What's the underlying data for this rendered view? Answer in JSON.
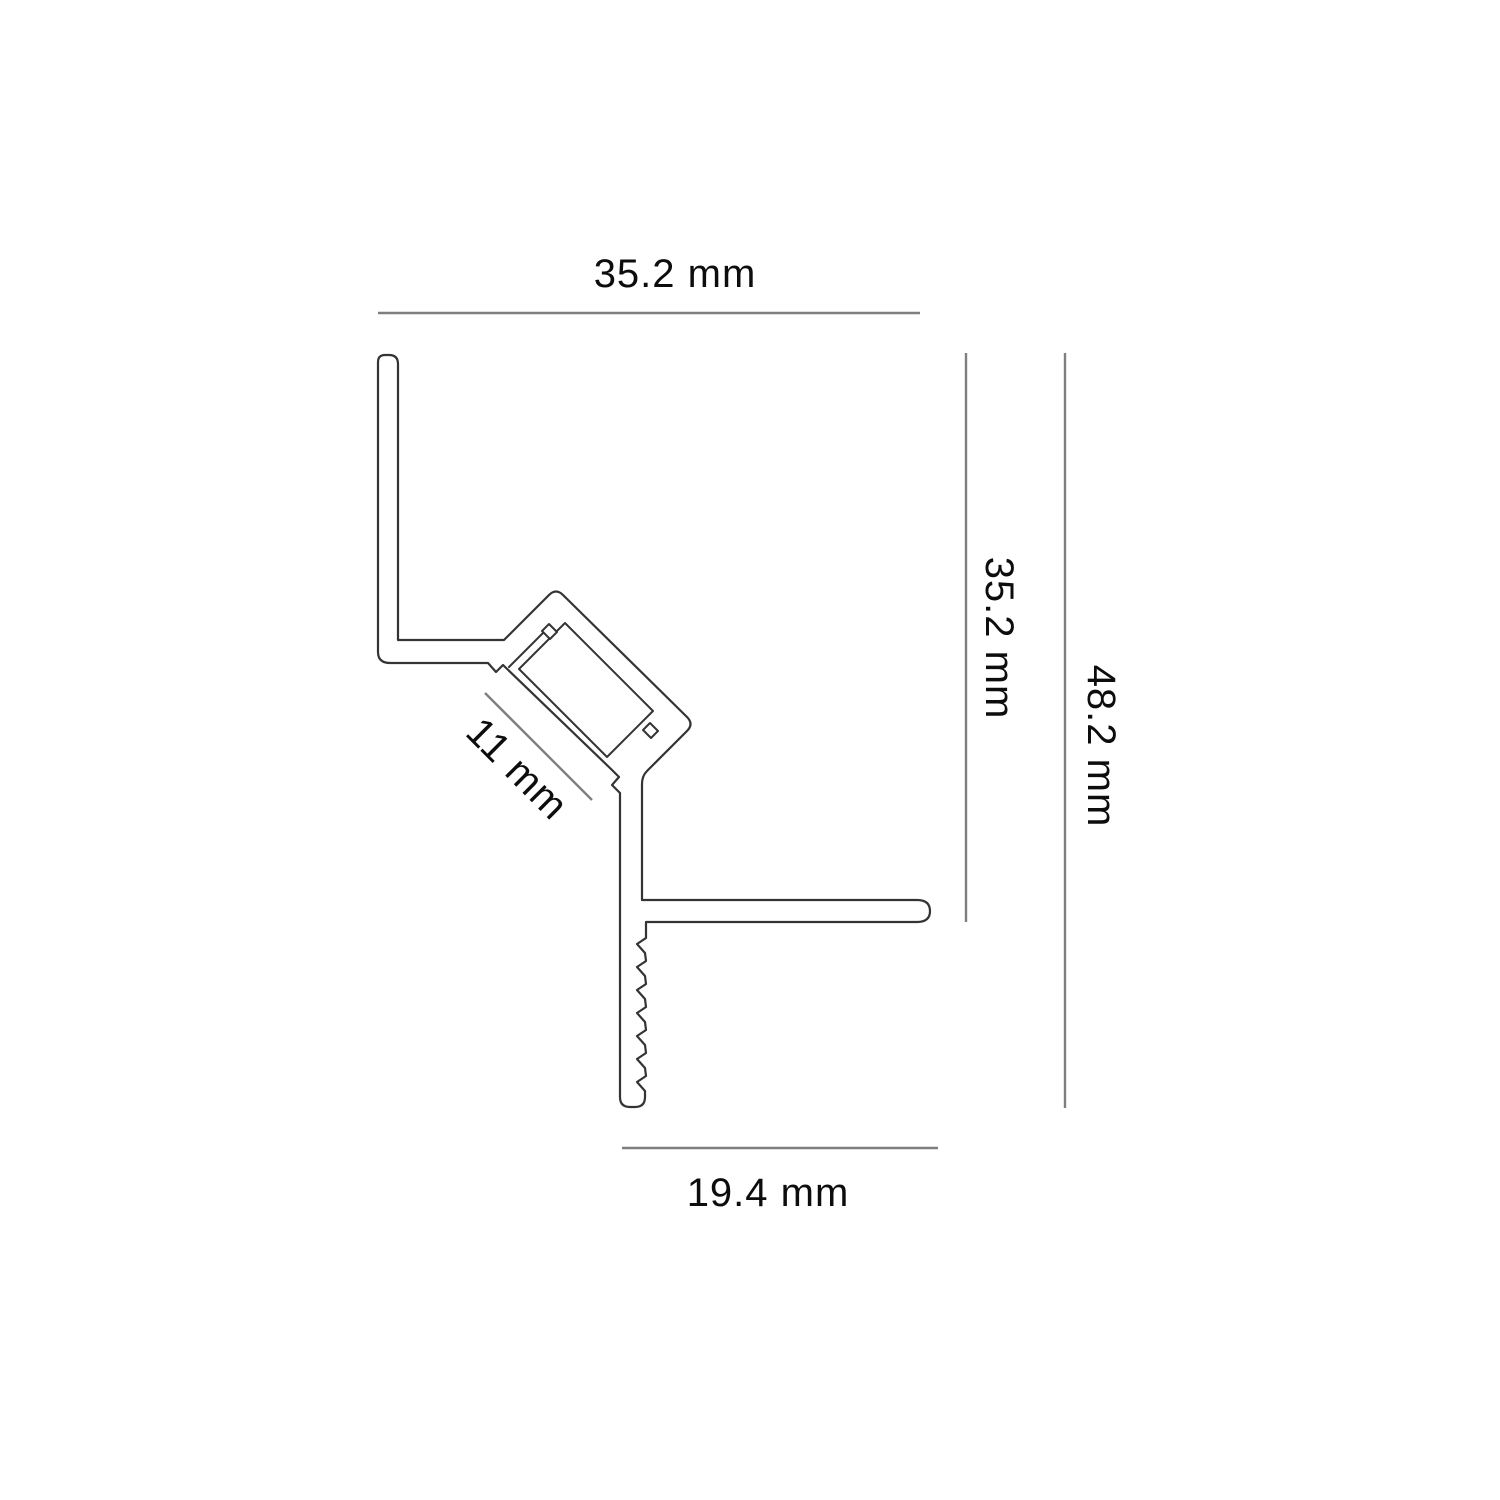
{
  "diagram": {
    "type": "technical-cross-section-led-corner-profile",
    "labels": {
      "top": "35.2 mm",
      "right_inner": "35.2 mm",
      "right_outer": "48.2 mm",
      "bottom": "19.4 mm",
      "channel": "11 mm"
    },
    "colors": {
      "outline": "#343434",
      "dimension_line": "#7f7f7f",
      "label_text": "#0d0d0d",
      "background": "#ffffff"
    }
  }
}
